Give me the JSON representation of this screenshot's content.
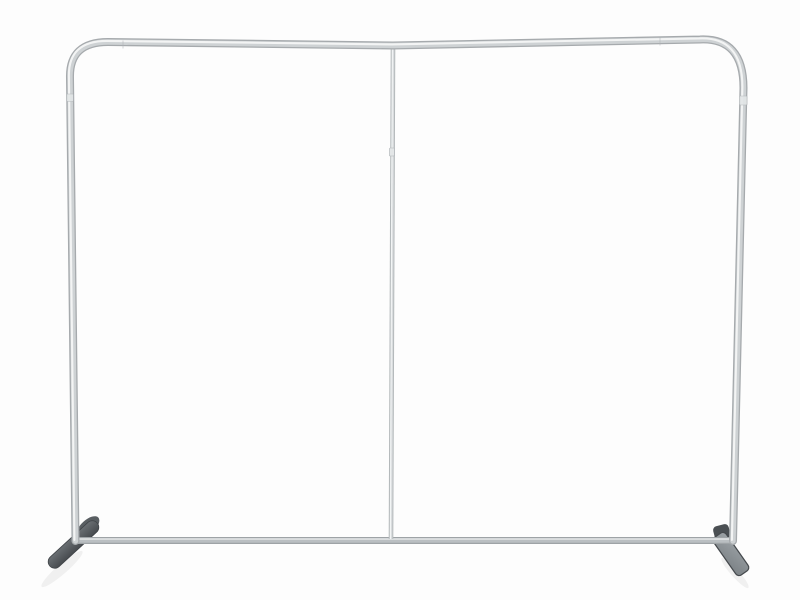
{
  "scene": {
    "type": "product-photo",
    "subject": "empty silver aluminum tube backdrop display frame with center pole and two feet on white background",
    "background": "#fdfdfd"
  },
  "palette": {
    "tube_edge": "#a6aaad",
    "tube_mid": "#ced2d4",
    "tube_highlight": "#f4f6f6",
    "bottom_edge": "#9ea3a6",
    "bottom_mid": "#babfc2",
    "bottom_highlight": "#e9ebec",
    "pole_edge": "#b3b8ba",
    "pole_mid": "#d9dcde",
    "pole_highlight": "#f3f5f5",
    "joint_fill": "#e3e6e7",
    "joint_line": "#b0b4b7",
    "foot_left_top": "#6a6f73",
    "foot_left_bottom": "#474b4f",
    "foot_left_stroke": "#3f4347",
    "foot_left_lobe": "#595e62",
    "right_knuckle": "#4a4f53",
    "right_plate_light": "#9ca2a6",
    "right_plate_dark": "#7b8185",
    "right_plate_stroke": "#45494d",
    "shadow": "#000000"
  }
}
